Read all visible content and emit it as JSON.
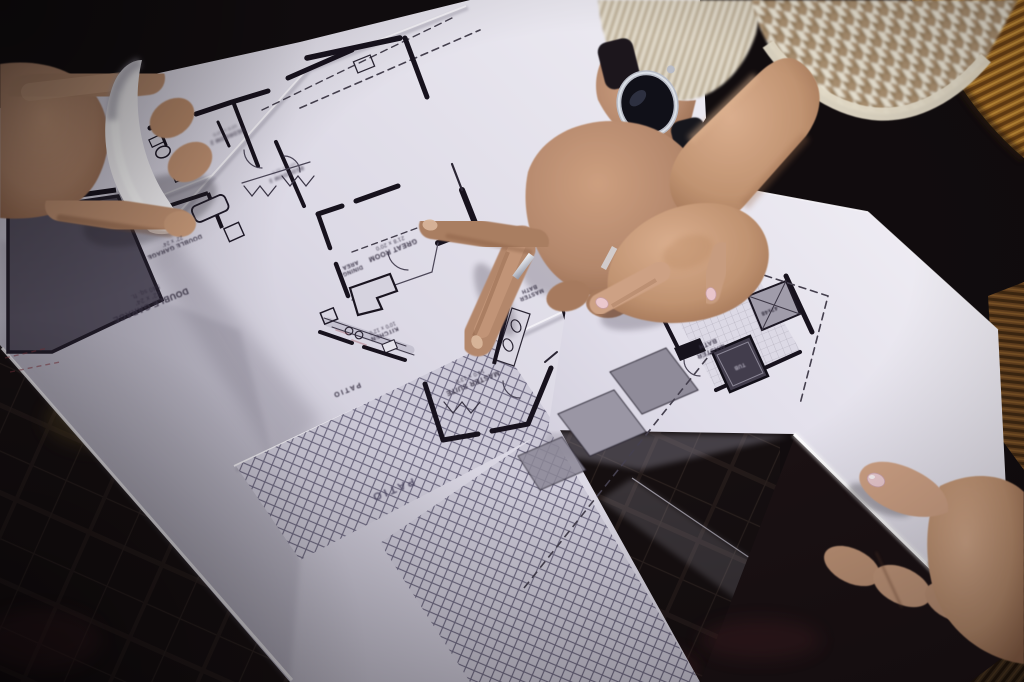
{
  "scene": {
    "description": "Close-up photograph of hands over architectural floor-plan blueprints: a man's hand with a wristwatch and a woman's hand point at rooms; another hand lifts a curled sheet corner and a fourth hand holds the sheet edge on a corduroy cushion",
    "objects": [
      "blueprint-sheets",
      "pointing-hands",
      "wristwatch",
      "wedding-ring",
      "knit-cuff",
      "houndstooth-sleeve",
      "corduroy-cushion"
    ]
  },
  "floor_plan": {
    "labels": {
      "double_garage_top": {
        "name": "DOUBLE GARAGE",
        "size": "22' x 24'"
      },
      "double_garage": {
        "name": "DOUBLE GARAGE",
        "size": "22' x 24'",
        "area": "540 sq. ft."
      },
      "great_room": {
        "name": "GREAT ROOM",
        "size": "21'8 x 20'0"
      },
      "dining": {
        "line1": "DINING",
        "line2": "AREA"
      },
      "kitchen": {
        "name": "KITCHEN",
        "size": "10'0 x 12'0"
      },
      "master_suite": {
        "name": "MASTER SUITE",
        "size": "14'0 x 13'0"
      },
      "master_bath_small": {
        "line1": "MASTER",
        "line2": "BATH"
      },
      "master_bath": {
        "line1": "MASTER",
        "line2": "BATH"
      },
      "bedroom_2": {
        "name": "BEDROOM 2",
        "size": "10'0 x 10'0"
      },
      "bedroom_3": {
        "name": "BEDROOM 3",
        "size": "10'0 x 11'0"
      },
      "patio_small": {
        "name": "PATIO"
      },
      "patio_large": {
        "name": "PATIO"
      },
      "shower": {
        "name": "47x48"
      },
      "tub": {
        "name": "TUB"
      }
    }
  },
  "colors": {
    "paper": "#dcd9e4",
    "paper_shadow": "#b0adbc",
    "ink": "#17121d",
    "dashed_line": "#45404e",
    "crosshatch": "#534e6b",
    "skin_male": "#b5876a",
    "skin_female": "#c2936f",
    "nail_polish": "#ecc8cd",
    "watch_face": "#101018",
    "watch_case": "#b9bcc6",
    "sweater_cuff": "#d8cfbd",
    "houndstooth_tan": "#ab9070",
    "cushion_ochre": "#a06a22",
    "corduroy_dark": "#3b2a17",
    "floor": "#150f10"
  }
}
